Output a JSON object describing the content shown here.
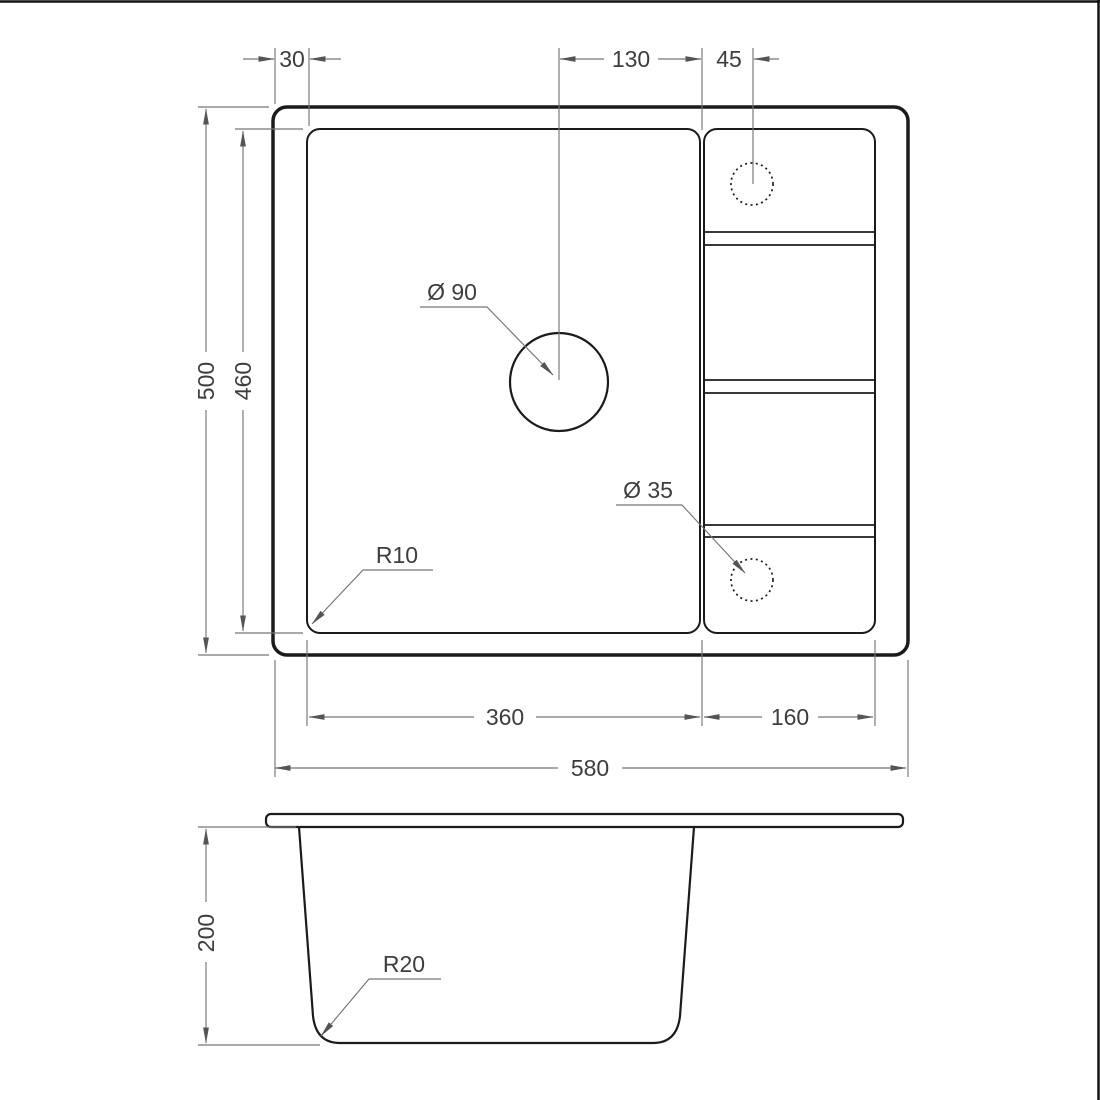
{
  "page": {
    "background": "#ffffff",
    "border_color": "#141414"
  },
  "colors": {
    "outline": "#1b1b1b",
    "dimension_line": "#767676",
    "dimension_text": "#3d3d3d"
  },
  "top_view": {
    "dim_rim_offset": "30",
    "dim_drain_to_bowl_edge": "130",
    "dim_tap_hole_offset": "45",
    "dim_outer_depth": "500",
    "dim_bowl_depth": "460",
    "dim_bowl_width": "360",
    "dim_drainboard_width": "160",
    "dim_outer_width": "580",
    "label_drain_hole_diameter": "Ø 90",
    "label_tap_hole_diameter": "Ø 35",
    "label_bowl_corner_radius": "R10"
  },
  "side_view": {
    "dim_depth": "200",
    "label_bottom_corner_radius": "R20"
  }
}
